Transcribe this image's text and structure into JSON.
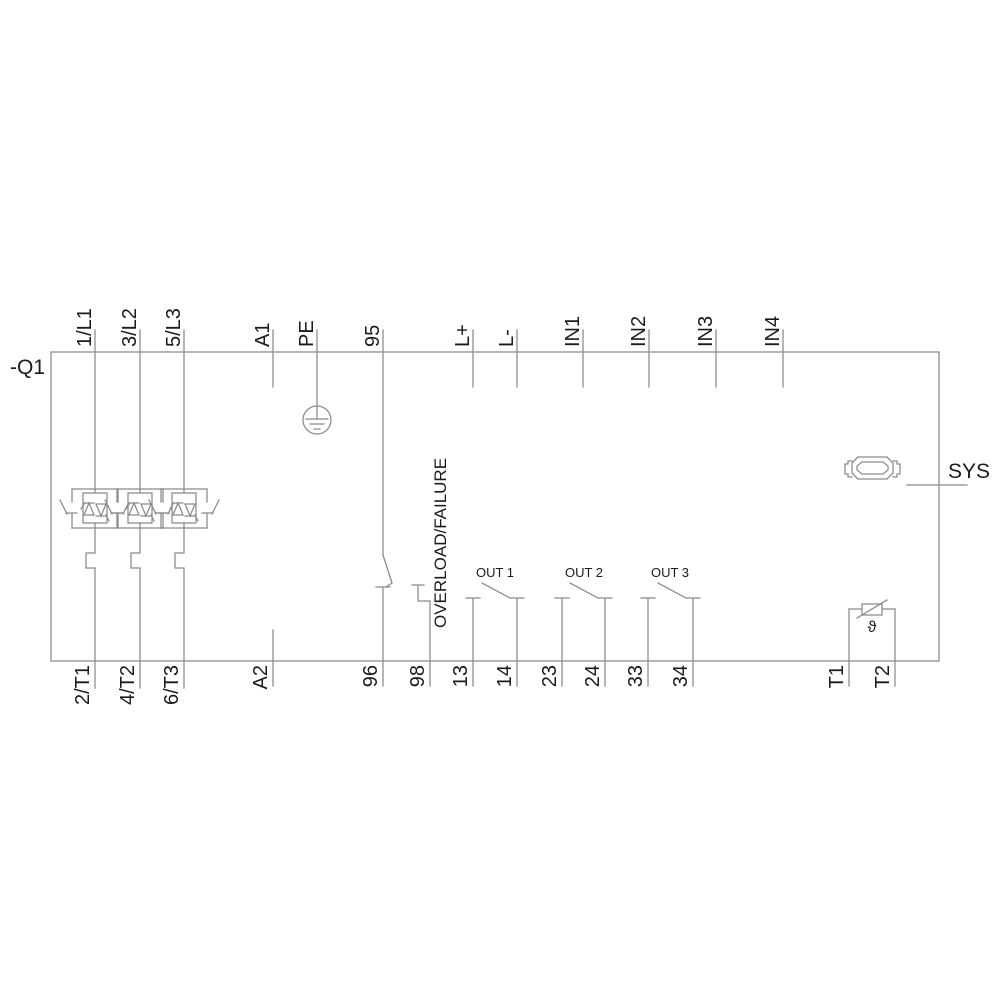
{
  "device_tag": "-Q1",
  "top_terminals": [
    {
      "label": "1/L1"
    },
    {
      "label": "3/L2"
    },
    {
      "label": "5/L3"
    },
    {
      "label": "A1"
    },
    {
      "label": "PE"
    },
    {
      "label": "95"
    },
    {
      "label": "L+"
    },
    {
      "label": "L-"
    },
    {
      "label": "IN1"
    },
    {
      "label": "IN2"
    },
    {
      "label": "IN3"
    },
    {
      "label": "IN4"
    }
  ],
  "bottom_terminals": [
    {
      "label": "2/T1"
    },
    {
      "label": "4/T2"
    },
    {
      "label": "6/T3"
    },
    {
      "label": "A2"
    },
    {
      "label": "96"
    },
    {
      "label": "98"
    },
    {
      "label": "13"
    },
    {
      "label": "14"
    },
    {
      "label": "23"
    },
    {
      "label": "24"
    },
    {
      "label": "33"
    },
    {
      "label": "34"
    },
    {
      "label": "T1"
    },
    {
      "label": "T2"
    }
  ],
  "annotations": {
    "overload": "OVERLOAD/FAILURE",
    "outputs": [
      "OUT 1",
      "OUT 2",
      "OUT 3"
    ],
    "sys": "SYS",
    "temperature_symbol": "ϑ"
  },
  "icons": {
    "pe": "earth-ground-icon",
    "sys": "system-connector-icon",
    "thermistor": "thermistor-icon",
    "phase_switch": "antiparallel-thyristor-with-bypass-icon"
  },
  "colors": {
    "line": "#8a8a8a",
    "text": "#1b1b1b",
    "background": "#ffffff"
  }
}
